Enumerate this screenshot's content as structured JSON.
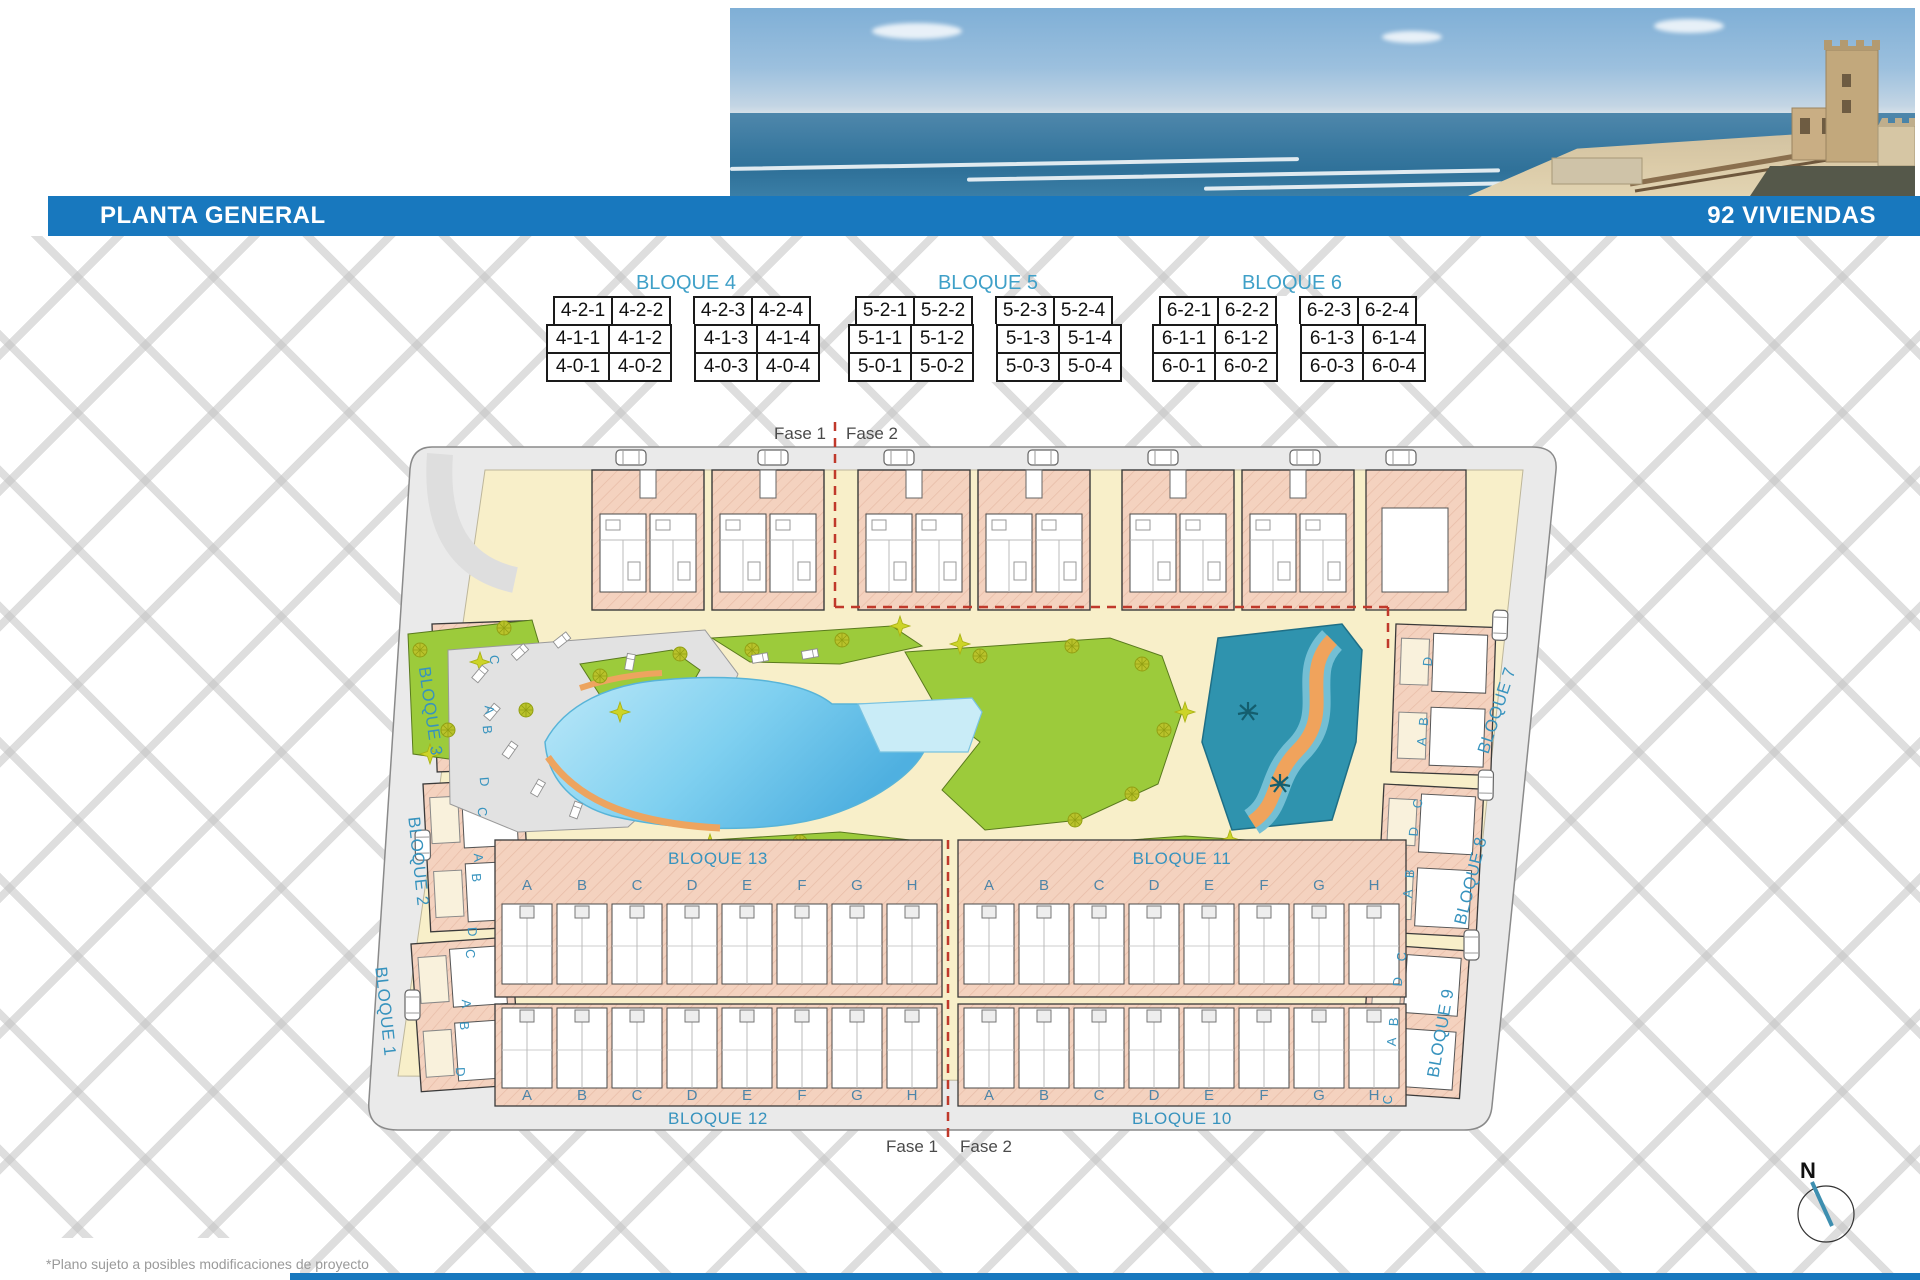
{
  "header": {
    "title": "PLANTA GENERAL",
    "units_badge": "92 VIVIENDAS"
  },
  "unit_tables": [
    {
      "title": "BLOQUE 4",
      "rows": [
        [
          "4-2-1",
          "4-2-2",
          "4-2-3",
          "4-2-4"
        ],
        [
          "4-1-1",
          "4-1-2",
          "4-1-3",
          "4-1-4"
        ],
        [
          "4-0-1",
          "4-0-2",
          "4-0-3",
          "4-0-4"
        ]
      ]
    },
    {
      "title": "BLOQUE 5",
      "rows": [
        [
          "5-2-1",
          "5-2-2",
          "5-2-3",
          "5-2-4"
        ],
        [
          "5-1-1",
          "5-1-2",
          "5-1-3",
          "5-1-4"
        ],
        [
          "5-0-1",
          "5-0-2",
          "5-0-3",
          "5-0-4"
        ]
      ]
    },
    {
      "title": "BLOQUE 6",
      "rows": [
        [
          "6-2-1",
          "6-2-2",
          "6-2-3",
          "6-2-4"
        ],
        [
          "6-1-1",
          "6-1-2",
          "6-1-3",
          "6-1-4"
        ],
        [
          "6-0-1",
          "6-0-2",
          "6-0-3",
          "6-0-4"
        ]
      ]
    }
  ],
  "plan": {
    "phase_labels": {
      "fase1": "Fase 1",
      "fase2": "Fase 2"
    },
    "block_labels": {
      "b1": "BLOQUE 1",
      "b2": "BLOQUE 2",
      "b3": "BLOQUE 3",
      "b7": "BLOQUE 7",
      "b8": "BLOQUE 8",
      "b9": "BLOQUE 9",
      "b10": "BLOQUE 10",
      "b11": "BLOQUE 11",
      "b12": "BLOQUE 12",
      "b13": "BLOQUE 13"
    },
    "unit_letters": [
      "A",
      "B",
      "C",
      "D",
      "E",
      "F",
      "G",
      "H"
    ],
    "side_letters": [
      "C",
      "A",
      "B",
      "D"
    ],
    "compass": "N"
  },
  "footnote": "*Plano sujeto a posibles modificaciones de proyecto",
  "colors": {
    "header_bar": "#1878BE",
    "accent_blue": "#3FA0C8",
    "phase_red": "#C0392B",
    "pool_blue": "#4FB6E8"
  }
}
